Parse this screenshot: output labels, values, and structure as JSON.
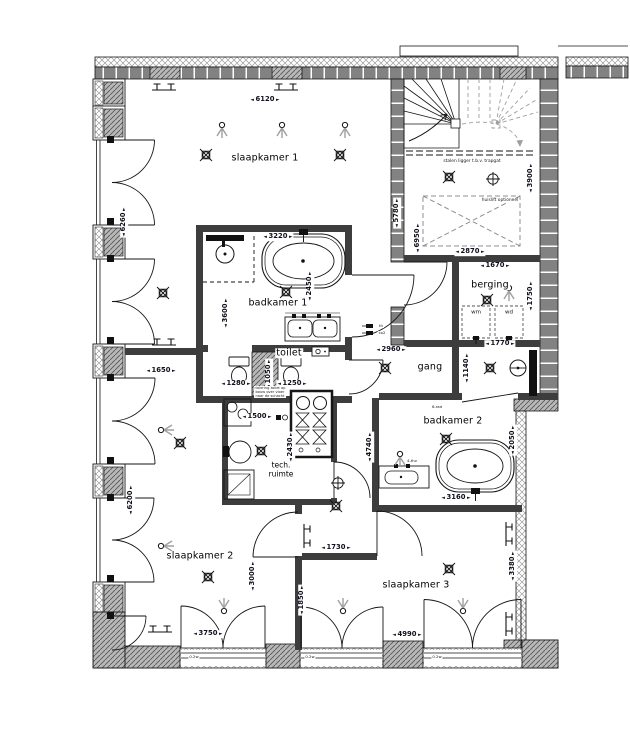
{
  "rooms": {
    "slaapkamer1": "slaapkamer 1",
    "badkamer1": "badkamer 1",
    "toilet": "toilet",
    "gang": "gang",
    "berging": "berging",
    "badkamer2": "badkamer 2",
    "tech1": "tech.",
    "tech2": "ruimte",
    "slaapkamer2": "slaapkamer 2",
    "slaapkamer3": "slaapkamer 3"
  },
  "dims": {
    "d6120": "6120",
    "d6260": "6260",
    "d6200": "6200",
    "d5780": "5780",
    "d6950": "6950",
    "d3900": "3900",
    "d2870": "2870",
    "d1670": "1670",
    "d1750": "1750",
    "d1770": "1770",
    "d1140": "1140",
    "d3220": "3220",
    "d2450": "2450",
    "d3600": "3600",
    "d1650": "1650",
    "d1280": "1280",
    "d1250": "1250",
    "d1050": "1050",
    "d2960": "2960",
    "d1500": "1500",
    "d2430": "2430",
    "d4740": "4740",
    "d3160": "3160",
    "d2050": "2050",
    "d1730": "1730",
    "d3000": "3000",
    "d1850": "1850",
    "d3380": "3380",
    "d3750": "3750",
    "d4990": "4990"
  },
  "notes": {
    "stalen_ligger": "stalen ligger t.b.v. trapgat",
    "huislift": "huislift optioneel",
    "riolering": "riolering toilet op bouw over vloer naar de schacht",
    "wm": "wm",
    "wd": "wd",
    "th": "th",
    "co2": "co2",
    "rad6": "6-rad",
    "thv4": "4-thv",
    "w02": "0.2w"
  },
  "colors": {
    "wall_brick": "#828282",
    "pier_hatch": "#b8b8b8",
    "insulation_hatch": "#9c9c9c",
    "dashed_gray": "#9e9e9e",
    "line": "#161616"
  }
}
